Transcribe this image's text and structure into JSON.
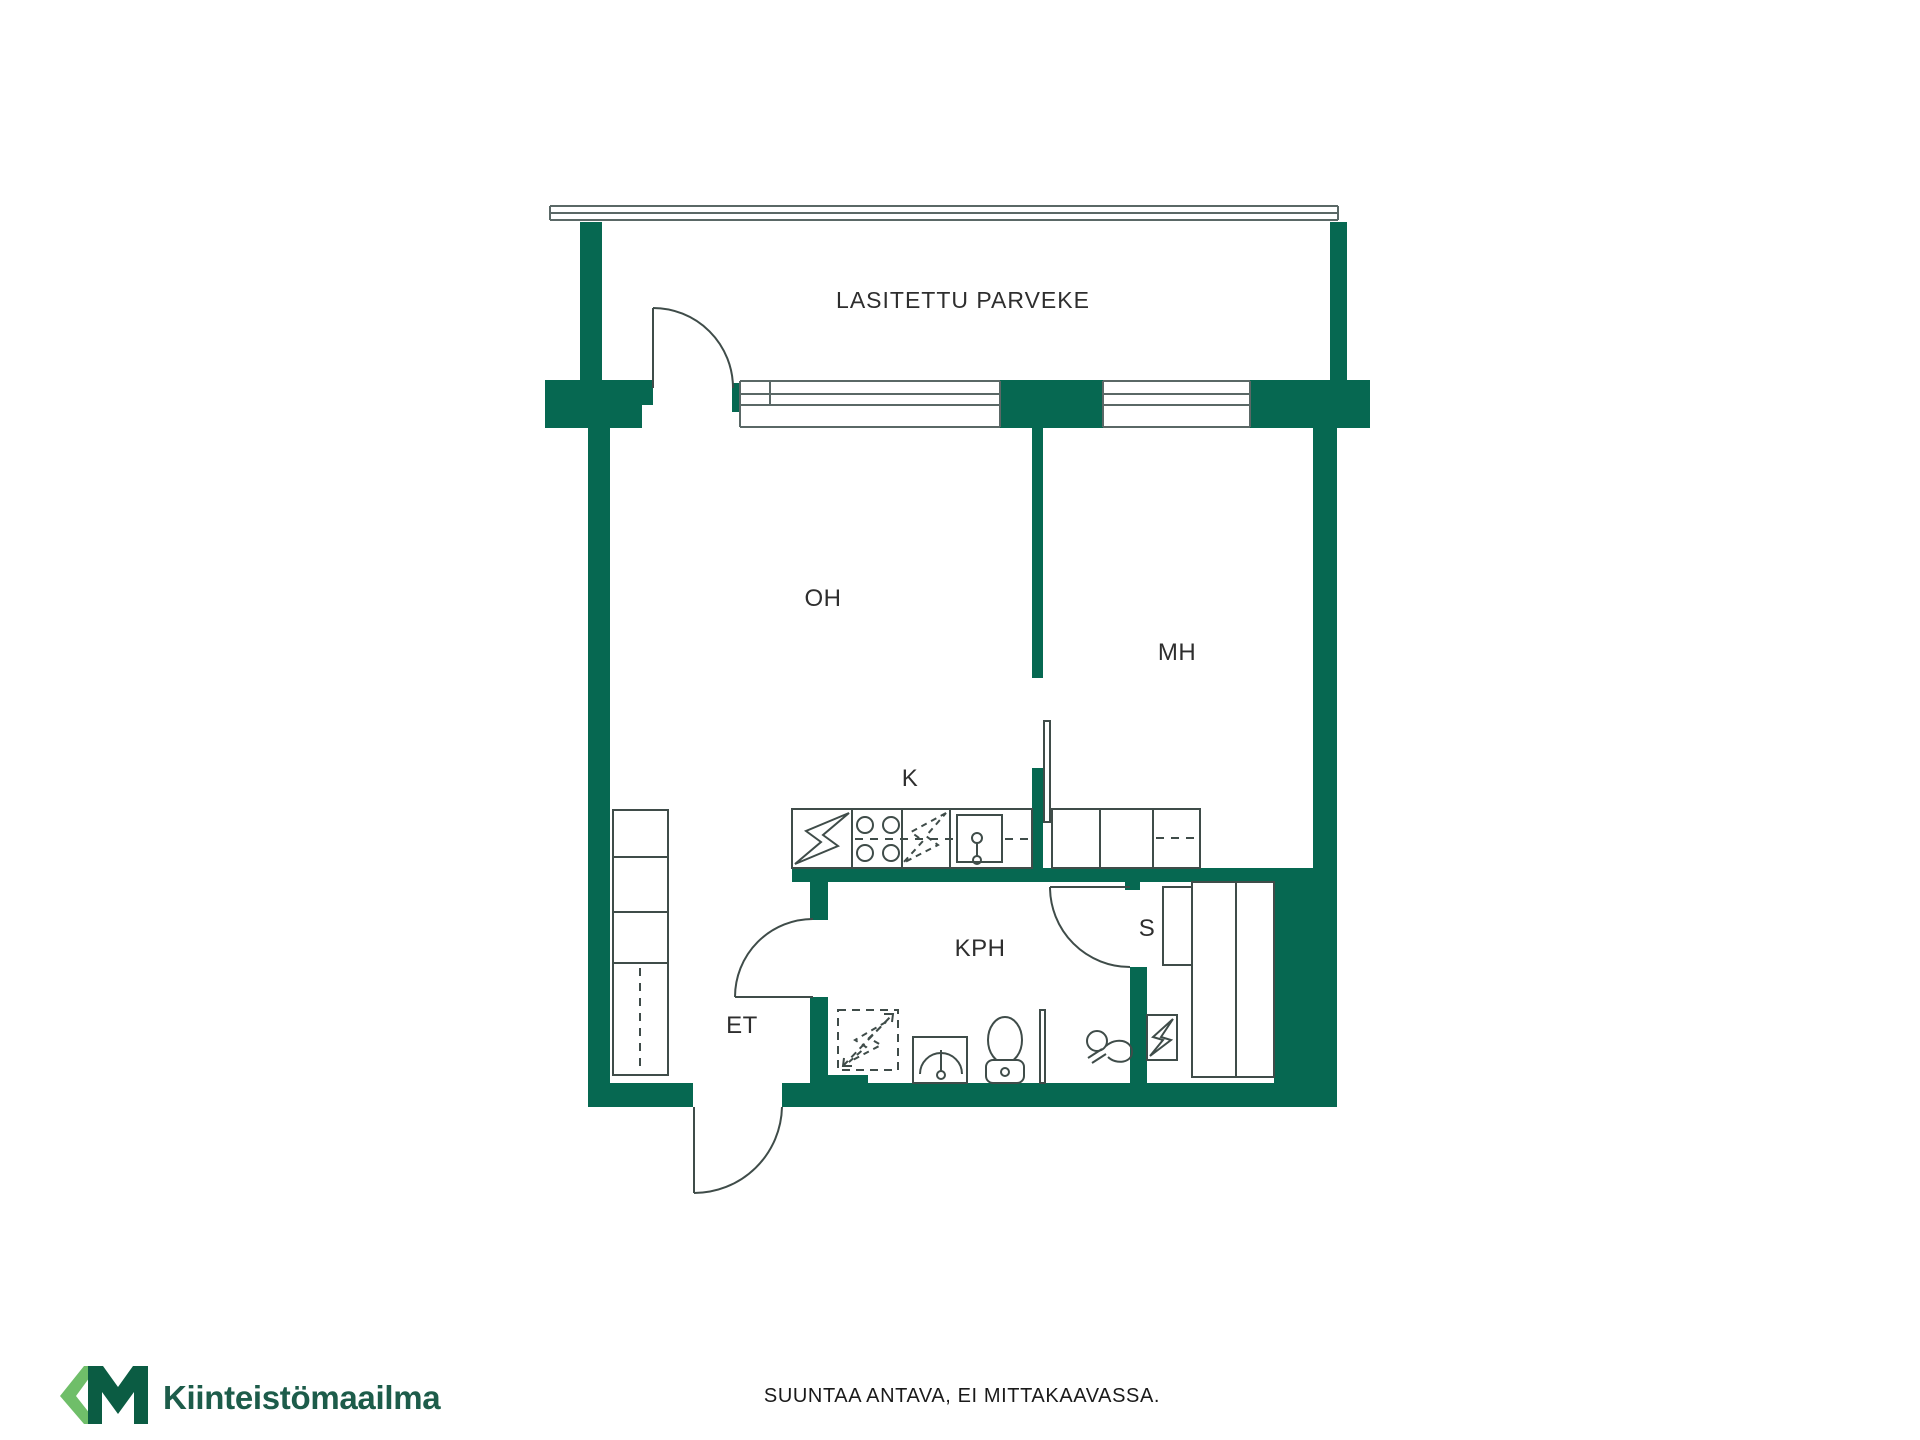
{
  "page": {
    "background": "#FFFFFF"
  },
  "brand": {
    "mark": "KM",
    "name": "Kiinteistömaailma",
    "green_dark": "#0B5C43",
    "green_light": "#6FBE69",
    "wordmark_color": "#1D5C4A"
  },
  "floorplan": {
    "wall_color": "#066851",
    "outline_color": "#3F4C49",
    "window_line_color": "#5A6866",
    "label_color": "#2E2E2E",
    "rooms": [
      {
        "label": "LASITETTU PARVEKE"
      },
      {
        "label": "OH"
      },
      {
        "label": "MH"
      },
      {
        "label": "K"
      },
      {
        "label": "KPH"
      },
      {
        "label": "S"
      },
      {
        "label": "ET"
      }
    ]
  },
  "footer": {
    "disclaimer": "SUUNTAA ANTAVA, EI MITTAKAAVASSA.",
    "color": "#1A1A1A"
  }
}
